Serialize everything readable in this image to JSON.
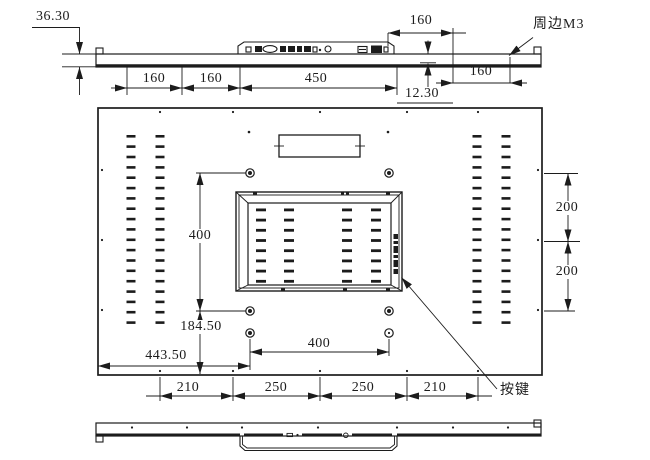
{
  "meta": {
    "drawing_type": "engineering dimension drawing",
    "line_color": "#1c1c1c",
    "background": "#ffffff"
  },
  "top_view": {
    "thickness": "36.30",
    "chain_seg1": "160",
    "chain_seg2": "160",
    "chain_seg3": "450",
    "upper_offset": "160",
    "right_offset": "160",
    "edge_gap": "12.30",
    "perimeter_note": "周边M3"
  },
  "rear_view": {
    "vesa_vertical": "400",
    "vesa_horizontal": "400",
    "bottom_hole_offset": "184.50",
    "left_hole_offset": "443.50",
    "right_top": "200",
    "right_bottom": "200",
    "bottom_chain": [
      "210",
      "250",
      "250",
      "210"
    ],
    "button_note": "按键"
  }
}
